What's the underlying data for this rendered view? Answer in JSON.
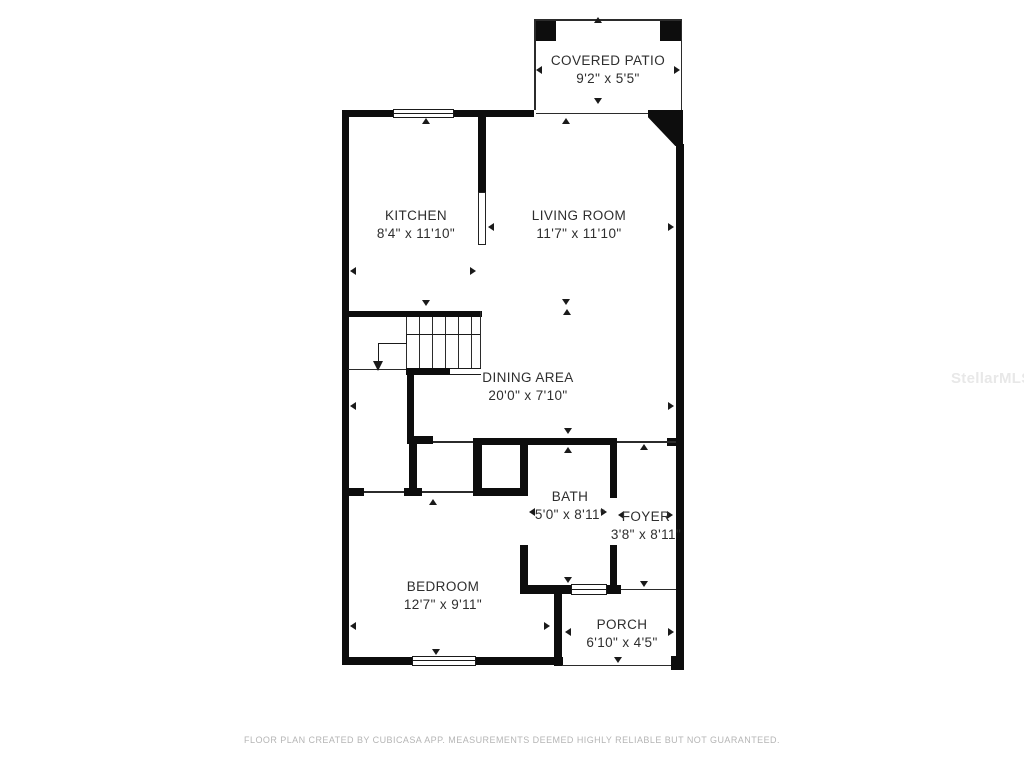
{
  "rooms": {
    "covered_patio": {
      "name": "COVERED PATIO",
      "dimensions": "9'2\" x 5'5\""
    },
    "kitchen": {
      "name": "KITCHEN",
      "dimensions": "8'4\" x 11'10\""
    },
    "living_room": {
      "name": "LIVING ROOM",
      "dimensions": "11'7\" x 11'10\""
    },
    "dining_area": {
      "name": "DINING AREA",
      "dimensions": "20'0\" x 7'10\""
    },
    "bath": {
      "name": "BATH",
      "dimensions": "5'0\" x 8'11\""
    },
    "foyer": {
      "name": "FOYER",
      "dimensions": "3'8\" x 8'11\""
    },
    "bedroom": {
      "name": "BEDROOM",
      "dimensions": "12'7\" x 9'11\""
    },
    "porch": {
      "name": "PORCH",
      "dimensions": "6'10\" x 4'5\""
    }
  },
  "footer": {
    "disclaimer": "FLOOR PLAN CREATED BY CUBICASA APP. MEASUREMENTS DEEMED HIGHLY RELIABLE BUT NOT GUARANTEED."
  },
  "watermark": {
    "text": "StellarMLS"
  },
  "colors": {
    "wall": "#0d0d0d",
    "label_text": "#2e2e2e",
    "footer_text": "#b5b5b5",
    "watermark_text": "#e8e8e8",
    "background": "#ffffff"
  }
}
